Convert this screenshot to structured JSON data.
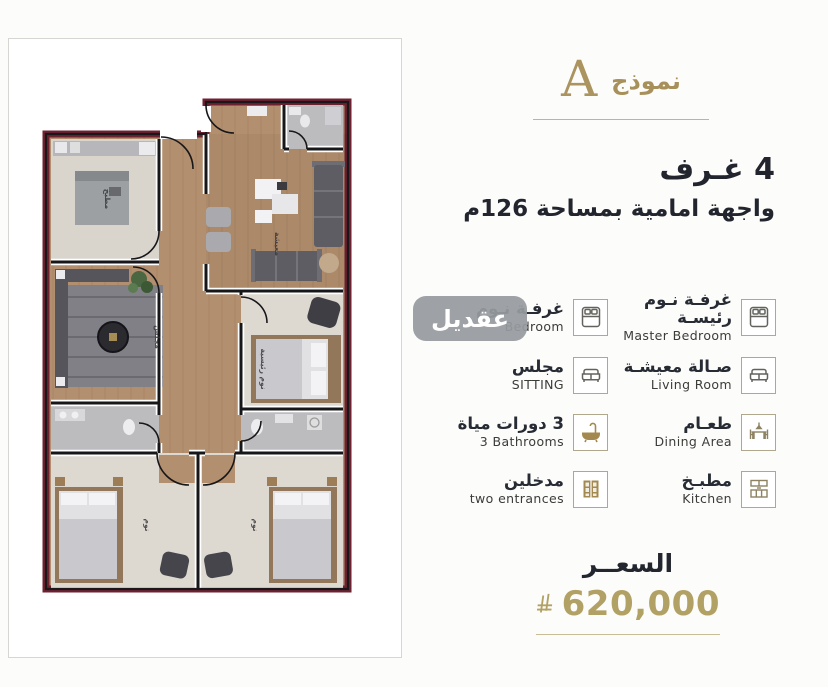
{
  "title": {
    "model_word": "نموذج",
    "model_letter": "A"
  },
  "subtitle": {
    "rooms_line": "4 غـرف",
    "facade_line": "واجهة امامية بمساحة 126م"
  },
  "features": [
    {
      "id": "master-bedroom",
      "ar": "غرفـة نـوم رئيسـة",
      "en": "Master Bedroom",
      "icon": "bed-icon"
    },
    {
      "id": "bedroom",
      "ar": "غرفـة نـوم",
      "en": "Bedroom",
      "icon": "bed-icon"
    },
    {
      "id": "living-room",
      "ar": "صـالة معيشـة",
      "en": "Living Room",
      "icon": "sofa-icon"
    },
    {
      "id": "sitting",
      "ar": "مجلس",
      "en": "SITTING",
      "icon": "sofa-icon"
    },
    {
      "id": "dining-area",
      "ar": "طعـام",
      "en": "Dining Area",
      "icon": "dining-icon"
    },
    {
      "id": "bathrooms",
      "ar": "3 دورات مياة",
      "en": "3 Bathrooms",
      "icon": "bathtub-icon"
    },
    {
      "id": "kitchen",
      "ar": "مطبـخ",
      "en": "Kitchen",
      "icon": "kitchen-icon"
    },
    {
      "id": "entrances",
      "ar": "مدخلين",
      "en": "two entrances",
      "icon": "door-icon"
    }
  ],
  "price": {
    "label": "السعــر",
    "amount": "620,000",
    "currency_icon": "saudi-riyal-symbol"
  },
  "watermark": {
    "text": "عقديل"
  },
  "floorplan": {
    "rooms": [
      {
        "label": "مطبخ"
      },
      {
        "label": "مجلس"
      },
      {
        "label": "معيشة"
      },
      {
        "label": "نوم رئيسية"
      },
      {
        "label": "نوم"
      },
      {
        "label": "نوم"
      }
    ],
    "wall_color": "#6e2130",
    "wood_color": "#b28f6e"
  },
  "colors": {
    "accent_gold": "#ab945f",
    "price_gold": "#b2a164",
    "icon_gold": "#a3894f",
    "dark_text": "#23262e",
    "divider_gray": "#b4b4b4"
  }
}
